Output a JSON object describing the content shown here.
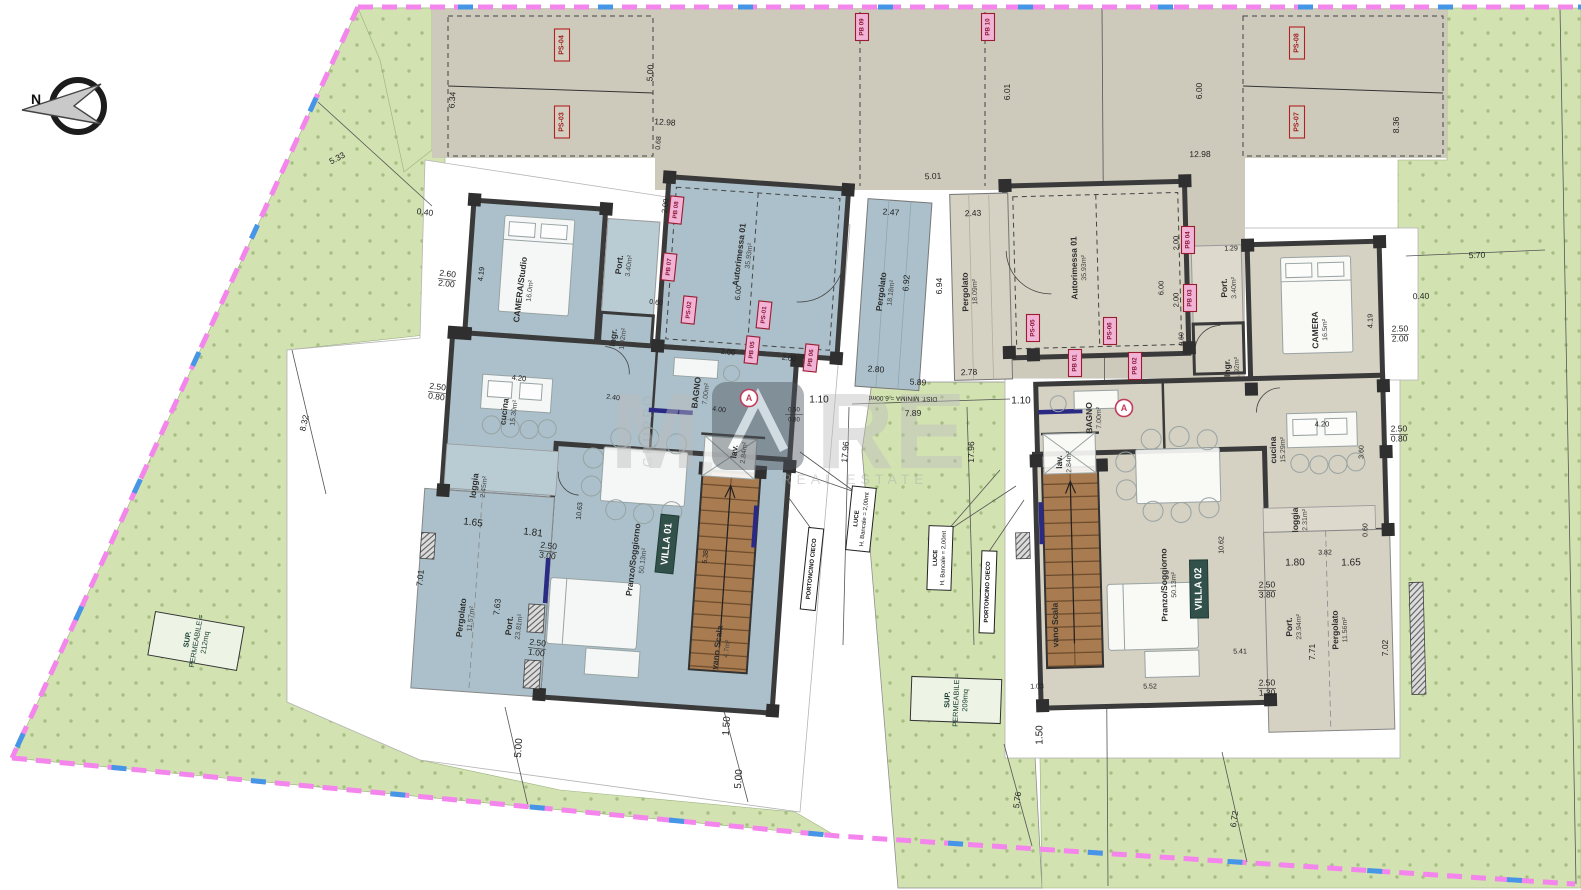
{
  "colors": {
    "grass": "#d3e2b1",
    "grass_dot": "#a6c084",
    "villa01_fill": "#abc0ca",
    "villa02_fill": "#d5d1c3",
    "parking_tan": "#cdc9bb",
    "wall": "#3a3a3a",
    "stairs": "#a87c50",
    "boundary_pink": "#f485ec",
    "boundary_blue": "#4596e6",
    "parking_label_red": "#9b1b2f",
    "parking_label_pink": "#f2b4d6",
    "badge_green": "#32514a",
    "sup_box_text": "#1d4034",
    "window_navy": "#2a2a85"
  },
  "compass": {
    "n": "N"
  },
  "watermark": {
    "part1": "M",
    "part2": "RE",
    "gruppo": "GRUPPO",
    "estate": "REAL ESTATE"
  },
  "badges": [
    {
      "t": "VILLA 01",
      "x": 667,
      "y": 544,
      "r": -84
    },
    {
      "t": "VILLA 02",
      "x": 1199,
      "y": 589,
      "r": -91
    }
  ],
  "circled": [
    {
      "t": "A",
      "x": 749,
      "y": 398
    },
    {
      "t": "A",
      "x": 1124,
      "y": 408
    }
  ],
  "labels": {
    "rooms": [
      {
        "n": "CAMERA/Studio",
        "a": "16.0m²",
        "x": 523,
        "y": 290,
        "r": -83
      },
      {
        "n": "Port.",
        "a": "3.40m²",
        "x": 622,
        "y": 265,
        "r": -83
      },
      {
        "n": "Ingr.",
        "a": "1.92m²",
        "x": 616,
        "y": 338,
        "r": -83
      },
      {
        "n": "Autorimessa 01",
        "a": "35.93m²",
        "x": 742,
        "y": 255,
        "r": -83
      },
      {
        "n": "Pergolato",
        "a": "18.18m²",
        "x": 884,
        "y": 292,
        "r": -83
      },
      {
        "n": "cucina",
        "a": "15.30m²",
        "x": 507,
        "y": 412,
        "r": -83
      },
      {
        "n": "BAGNO",
        "a": "7.00m²",
        "x": 699,
        "y": 393,
        "r": -83
      },
      {
        "n": "lav.",
        "a": "2.84m²",
        "x": 737,
        "y": 452,
        "r": -83
      },
      {
        "n": "loggia",
        "a": "2.45m²",
        "x": 477,
        "y": 486,
        "r": -83
      },
      {
        "n": "Pranzo/Soggiorno",
        "a": "50.13m²",
        "x": 636,
        "y": 560,
        "r": -83
      },
      {
        "n": "Pergolato",
        "a": "11.57m²",
        "x": 464,
        "y": 618,
        "r": -83
      },
      {
        "n": "Port.",
        "a": "23.81m²",
        "x": 512,
        "y": 626,
        "r": -83
      },
      {
        "n": "vano Scala",
        "a": "4.7m²",
        "x": 720,
        "y": 648,
        "r": -83
      },
      {
        "n": "Autorimessa 01",
        "a": "35.93m²",
        "x": 1077,
        "y": 268,
        "r": -91
      },
      {
        "n": "Pergolato",
        "a": "18.09m²",
        "x": 968,
        "y": 292,
        "r": -91
      },
      {
        "n": "Port.",
        "a": "3.40m²",
        "x": 1227,
        "y": 288,
        "r": -91
      },
      {
        "n": "Ingr.",
        "a": "1.92m²",
        "x": 1230,
        "y": 368,
        "r": -91
      },
      {
        "n": "CAMERA",
        "a": "16.5m²",
        "x": 1318,
        "y": 330,
        "r": -91
      },
      {
        "n": "BAGNO",
        "a": "7.00m²",
        "x": 1092,
        "y": 418,
        "r": -91
      },
      {
        "n": "lav.",
        "a": "2.84m²",
        "x": 1062,
        "y": 462,
        "r": -91
      },
      {
        "n": "cucina",
        "a": "15.29m²",
        "x": 1276,
        "y": 450,
        "r": -91
      },
      {
        "n": "loggia",
        "a": "2.31m²",
        "x": 1298,
        "y": 520,
        "r": -91
      },
      {
        "n": "Pranzo/Soggiorno",
        "a": "50.13m²",
        "x": 1167,
        "y": 585,
        "r": -91
      },
      {
        "n": "Port.",
        "a": "23.94m²",
        "x": 1292,
        "y": 627,
        "r": -91
      },
      {
        "n": "Pergolato",
        "a": "11.56m²",
        "x": 1338,
        "y": 630,
        "r": -91
      },
      {
        "n": "vano Scala",
        "a": "",
        "x": 1058,
        "y": 625,
        "r": -91
      }
    ],
    "dims": [
      {
        "t": "5.33",
        "x": 337,
        "y": 158,
        "r": -28
      },
      {
        "t": "0.40",
        "x": 425,
        "y": 212,
        "r": 7
      },
      {
        "t": "8.32",
        "x": 304,
        "y": 423,
        "r": -77
      },
      {
        "t": "6.34",
        "x": 452,
        "y": 100,
        "r": -86
      },
      {
        "t": "5.00",
        "x": 650,
        "y": 73,
        "r": -86
      },
      {
        "t": "12.98",
        "x": 665,
        "y": 122,
        "r": 4
      },
      {
        "t": "0.68",
        "x": 659,
        "y": 143,
        "r": -86,
        "s": 7
      },
      {
        "t": "5.01",
        "x": 933,
        "y": 176,
        "r": -3
      },
      {
        "t": "2.47",
        "x": 891,
        "y": 212,
        "r": 4
      },
      {
        "t": "2.43",
        "x": 973,
        "y": 213,
        "r": -2
      },
      {
        "t": "6.92",
        "x": 906,
        "y": 283,
        "r": -85
      },
      {
        "t": "6.94",
        "x": 939,
        "y": 286,
        "r": -89
      },
      {
        "t": "2.80",
        "x": 876,
        "y": 369,
        "r": 4
      },
      {
        "t": "2.78",
        "x": 969,
        "y": 372,
        "r": -2
      },
      {
        "t": "5.89",
        "x": 918,
        "y": 382,
        "r": 4
      },
      {
        "t": "6.01",
        "x": 1007,
        "y": 92,
        "r": -90
      },
      {
        "t": "6.00",
        "x": 1199,
        "y": 91,
        "r": -90
      },
      {
        "t": "12.98",
        "x": 1200,
        "y": 154,
        "r": -1
      },
      {
        "t": "8.36",
        "x": 1396,
        "y": 125,
        "r": -90
      },
      {
        "t": "5.70",
        "x": 1477,
        "y": 255,
        "r": -2
      },
      {
        "t": "0.40",
        "x": 1421,
        "y": 296,
        "r": -2
      },
      {
        "t": "2.00",
        "x": 728,
        "y": 352,
        "r": 7,
        "s": 7.5
      },
      {
        "t": "2.00",
        "x": 789,
        "y": 358,
        "r": 7,
        "s": 7.5
      },
      {
        "t": "1.10",
        "x": 819,
        "y": 400,
        "r": 0,
        "s": 10
      },
      {
        "t": "7.89",
        "x": 913,
        "y": 413,
        "r": -2
      },
      {
        "t": "DIST. MINIMA = 6.00mt",
        "x": 903,
        "y": 398,
        "r": 181,
        "s": 6.5
      },
      {
        "t": "1.10",
        "x": 1021,
        "y": 401,
        "r": 0,
        "s": 10
      },
      {
        "t": "17.96",
        "x": 845,
        "y": 452,
        "r": -85
      },
      {
        "t": "17.96",
        "x": 971,
        "y": 452,
        "r": -89
      },
      {
        "t": "2.60",
        "t2": "2.00",
        "x": 447,
        "y": 279,
        "r": 7
      },
      {
        "t": "4.19",
        "x": 481,
        "y": 274,
        "r": -83,
        "s": 7.5
      },
      {
        "t": "2.50",
        "t2": "0.80",
        "x": 437,
        "y": 392,
        "r": 7
      },
      {
        "t": "4.20",
        "x": 519,
        "y": 378,
        "r": 7,
        "s": 7.5
      },
      {
        "t": "1.65",
        "x": 473,
        "y": 523,
        "r": 7,
        "s": 10
      },
      {
        "t": "1.81",
        "x": 533,
        "y": 533,
        "r": 7,
        "s": 10
      },
      {
        "t": "7.01",
        "x": 420,
        "y": 578,
        "r": -84
      },
      {
        "t": "7.63",
        "x": 497,
        "y": 607,
        "r": -84
      },
      {
        "t": "2.50",
        "t2": "3.00",
        "x": 548,
        "y": 551,
        "r": 7
      },
      {
        "t": "2.50",
        "t2": "1.00",
        "x": 537,
        "y": 648,
        "r": 7
      },
      {
        "t": "1.50",
        "x": 727,
        "y": 726,
        "r": -86,
        "s": 10
      },
      {
        "t": "5.00",
        "x": 519,
        "y": 748,
        "r": -86,
        "s": 10
      },
      {
        "t": "5.00",
        "x": 739,
        "y": 779,
        "r": -86,
        "s": 10
      },
      {
        "t": "2.00",
        "x": 665,
        "y": 206,
        "r": -83,
        "s": 7.5
      },
      {
        "t": "6.00",
        "x": 738,
        "y": 293,
        "r": -84,
        "s": 7.5
      },
      {
        "t": "0.60",
        "x": 656,
        "y": 303,
        "r": 7,
        "s": 7
      },
      {
        "t": "2.40",
        "x": 613,
        "y": 398,
        "r": 7,
        "s": 7
      },
      {
        "t": "4.00",
        "x": 719,
        "y": 410,
        "r": 7,
        "s": 7
      },
      {
        "t": "0.50",
        "t2": "0.80",
        "x": 794,
        "y": 414,
        "r": 0,
        "s": 6
      },
      {
        "t": "5.38",
        "x": 706,
        "y": 557,
        "r": -84,
        "s": 7
      },
      {
        "t": "10.63",
        "x": 580,
        "y": 511,
        "r": -84,
        "s": 7
      },
      {
        "t": "2.00",
        "x": 1176,
        "y": 243,
        "r": -91,
        "s": 7.5
      },
      {
        "t": "2.00",
        "x": 1176,
        "y": 300,
        "r": -91,
        "s": 7.5
      },
      {
        "t": "0.60",
        "x": 1182,
        "y": 339,
        "r": -91,
        "s": 7
      },
      {
        "t": "6.00",
        "x": 1161,
        "y": 288,
        "r": -90,
        "s": 7.5
      },
      {
        "t": "1.29",
        "x": 1231,
        "y": 249,
        "r": -1,
        "s": 7
      },
      {
        "t": "4.19",
        "x": 1370,
        "y": 321,
        "r": -90,
        "s": 7.5
      },
      {
        "t": "2.50",
        "t2": "2.00",
        "x": 1400,
        "y": 334,
        "r": -1
      },
      {
        "t": "4.20",
        "x": 1322,
        "y": 424,
        "r": -1,
        "s": 7.5
      },
      {
        "t": "2.50",
        "t2": "0.80",
        "x": 1399,
        "y": 434,
        "r": -1
      },
      {
        "t": "3.60",
        "x": 1362,
        "y": 452,
        "r": -89,
        "s": 7
      },
      {
        "t": "3.82",
        "x": 1325,
        "y": 553,
        "r": -1,
        "s": 7
      },
      {
        "t": "0.60",
        "x": 1366,
        "y": 530,
        "r": -90,
        "s": 7
      },
      {
        "t": "1.80",
        "x": 1295,
        "y": 563,
        "r": -1,
        "s": 10
      },
      {
        "t": "1.65",
        "x": 1351,
        "y": 563,
        "r": -1,
        "s": 10
      },
      {
        "t": "7.71",
        "x": 1312,
        "y": 652,
        "r": -90
      },
      {
        "t": "7.02",
        "x": 1385,
        "y": 648,
        "r": -90
      },
      {
        "t": "2.50",
        "t2": "3.80",
        "x": 1267,
        "y": 590,
        "r": -1
      },
      {
        "t": "2.50",
        "t2": "1.30",
        "x": 1267,
        "y": 688,
        "r": -1
      },
      {
        "t": "1.50",
        "x": 1040,
        "y": 735,
        "r": -90,
        "s": 10
      },
      {
        "t": "5.76",
        "x": 1017,
        "y": 800,
        "r": -82
      },
      {
        "t": "6.72",
        "x": 1234,
        "y": 819,
        "r": -82
      },
      {
        "t": "5.41",
        "x": 1240,
        "y": 652,
        "r": -1,
        "s": 7
      },
      {
        "t": "5.52",
        "x": 1150,
        "y": 687,
        "r": -1,
        "s": 7
      },
      {
        "t": "1.03",
        "x": 1037,
        "y": 687,
        "r": -1,
        "s": 7
      },
      {
        "t": "10.62",
        "x": 1222,
        "y": 545,
        "r": -90,
        "s": 7
      }
    ],
    "parking": [
      {
        "t": "PS-04",
        "x": 562,
        "y": 45,
        "r": -90,
        "k": "tan"
      },
      {
        "t": "PS-03",
        "x": 562,
        "y": 122,
        "r": -90,
        "k": "tan"
      },
      {
        "t": "PS-08",
        "x": 1297,
        "y": 43,
        "r": -90,
        "k": "tan"
      },
      {
        "t": "PS-07",
        "x": 1297,
        "y": 122,
        "r": -90,
        "k": "tan"
      },
      {
        "t": "PB 09",
        "x": 862,
        "y": 27,
        "r": -90,
        "k": "pink"
      },
      {
        "t": "PB 10",
        "x": 988,
        "y": 27,
        "r": -90,
        "k": "pink"
      },
      {
        "t": "PB 08",
        "x": 676,
        "y": 210,
        "r": -84,
        "k": "pink"
      },
      {
        "t": "PB 07",
        "x": 669,
        "y": 267,
        "r": -84,
        "k": "pink"
      },
      {
        "t": "PS-02",
        "x": 689,
        "y": 310,
        "r": -84,
        "k": "pink"
      },
      {
        "t": "PS-01",
        "x": 764,
        "y": 315,
        "r": -84,
        "k": "pink"
      },
      {
        "t": "PB 05",
        "x": 752,
        "y": 350,
        "r": -84,
        "k": "pink"
      },
      {
        "t": "PB 06",
        "x": 811,
        "y": 358,
        "r": -84,
        "k": "pink"
      },
      {
        "t": "PS-05",
        "x": 1033,
        "y": 328,
        "r": -90,
        "k": "pink"
      },
      {
        "t": "PS-06",
        "x": 1110,
        "y": 331,
        "r": -90,
        "k": "pink"
      },
      {
        "t": "PB 04",
        "x": 1188,
        "y": 240,
        "r": -90,
        "k": "pink"
      },
      {
        "t": "PB 03",
        "x": 1190,
        "y": 298,
        "r": -90,
        "k": "pink"
      },
      {
        "t": "PB 01",
        "x": 1075,
        "y": 363,
        "r": -90,
        "k": "pink"
      },
      {
        "t": "PB 02",
        "x": 1135,
        "y": 366,
        "r": -90,
        "k": "pink"
      }
    ],
    "boxes": [
      {
        "l": [
          "SUP.",
          "PERMEABILE =",
          "212mq"
        ],
        "x": 196,
        "y": 641,
        "r": -80,
        "w": 44,
        "h": 90,
        "k": "sup"
      },
      {
        "l": [
          "SUP.",
          "PERMEABILE =",
          "209mq"
        ],
        "x": 956,
        "y": 700,
        "r": -88,
        "w": 44,
        "h": 90,
        "k": "sup"
      },
      {
        "l": [
          "LUCE",
          "H. Bancale = 2,00mt"
        ],
        "x": 861,
        "y": 519,
        "r": -84,
        "w": 64,
        "h": 24,
        "k": "luce"
      },
      {
        "l": [
          "LUCE",
          "H. Bancale = 2,00mt"
        ],
        "x": 940,
        "y": 558,
        "r": -88,
        "w": 64,
        "h": 24,
        "k": "luce"
      },
      {
        "l": [
          "PORTONCINO CIECO"
        ],
        "x": 812,
        "y": 569,
        "r": -84,
        "w": 82,
        "h": 15,
        "k": "porton"
      },
      {
        "l": [
          "PORTONCINO CIECO"
        ],
        "x": 988,
        "y": 592,
        "r": -88,
        "w": 82,
        "h": 15,
        "k": "porton"
      }
    ]
  }
}
